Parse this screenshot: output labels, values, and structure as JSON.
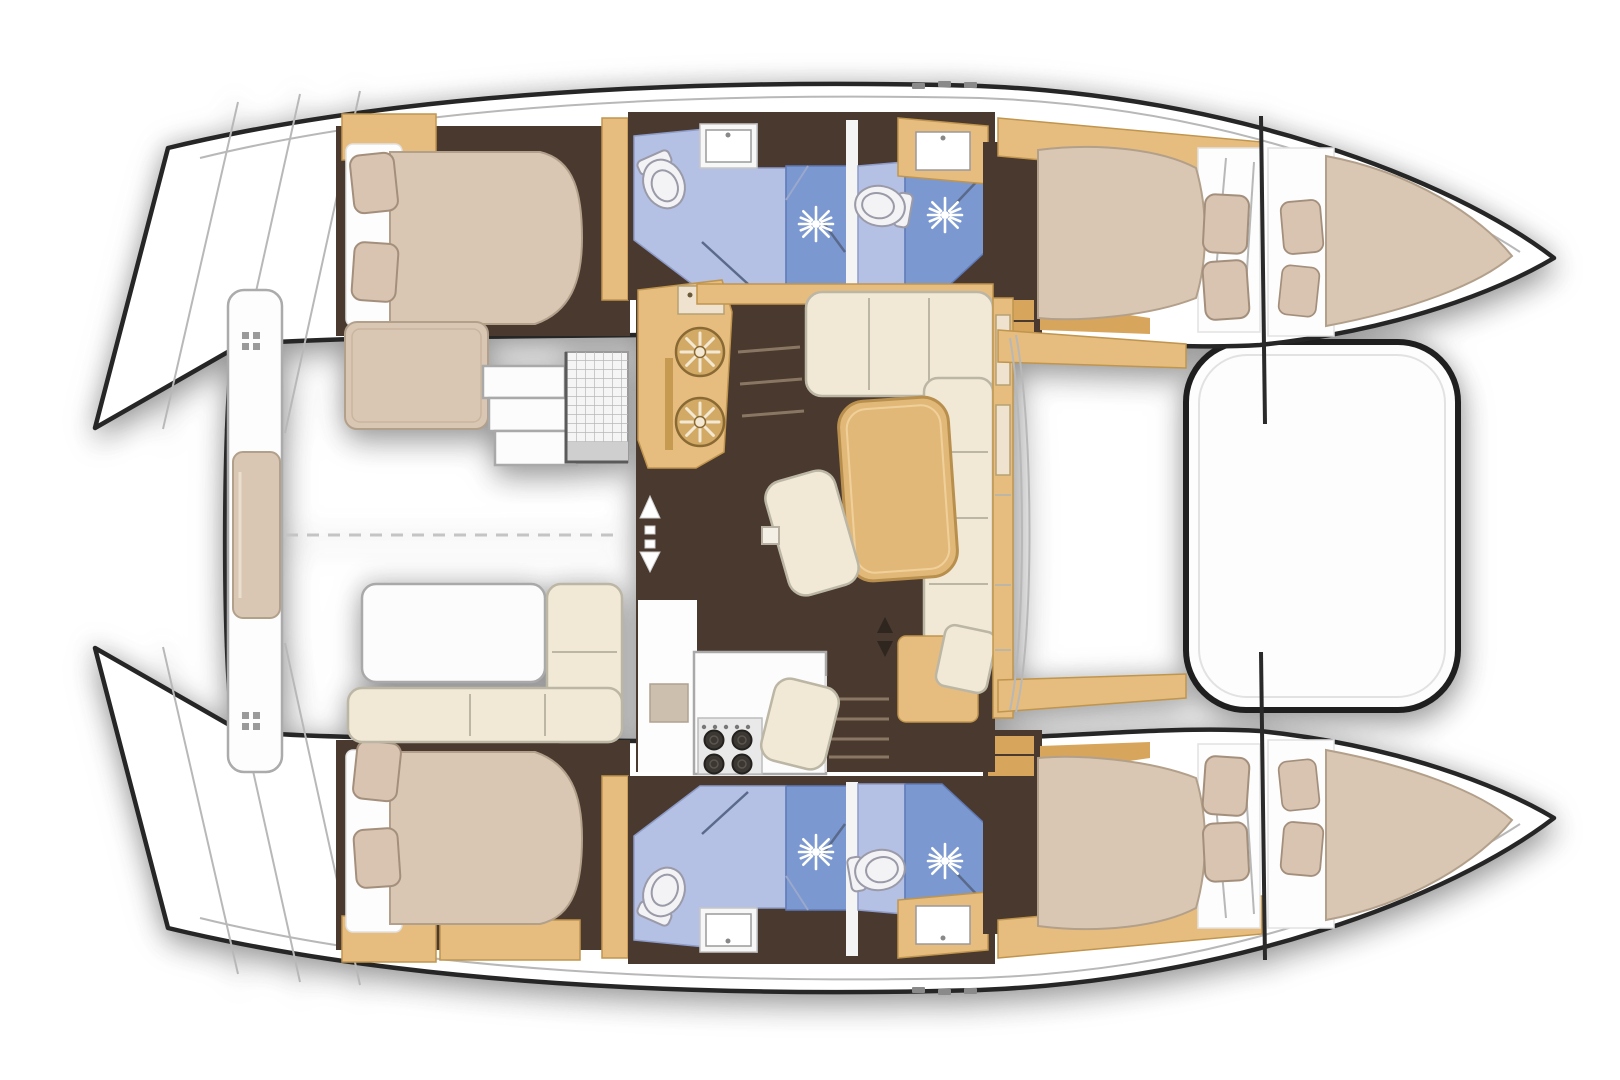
{
  "title": "Sailing catamaran interior floor plan — top-down layout, bows to the right: 4 double cabins, 4 bathrooms with showers, central saloon with galley, aft cockpit, bow trampoline",
  "plan": {
    "vessel_type": "sailing catamaran",
    "view": "top-down",
    "bow_side": "right",
    "stern_side": "left",
    "hulls": [
      "port hull (top)",
      "starboard hull (bottom)"
    ],
    "areas": [
      "aft cockpit",
      "saloon",
      "galley",
      "port aft cabin",
      "port forward cabin",
      "starboard aft cabin",
      "starboard forward cabin",
      "4 bathrooms",
      "2 forepeak berths",
      "foredeck",
      "trampoline",
      "transom steps"
    ]
  },
  "inventory": {
    "double_berths": 4,
    "forepeak_berths": 2,
    "pillows": 12,
    "toilets": 4,
    "showers": 4,
    "washbasins": 4,
    "galley_round_sinks": 2,
    "stove_burners": 4,
    "dining_table": 1,
    "ottomans": 2,
    "saloon_sofa_sections": 8,
    "cockpit_table": 1,
    "cockpit_settee": 1,
    "sunpad": 1,
    "liferaft_locker": 1,
    "trampoline": 1
  },
  "colors": {
    "background": "#ffffff",
    "hull-fill": "#ffffff",
    "hull-stroke": "#262626",
    "deck-line": "#b8b8b8",
    "floor-brown": "#4a392e",
    "wood": "#e6bd7e",
    "wood-dark": "#c0954e",
    "wood-mid": "#d8a55c",
    "wood-pale": "#efe3cf",
    "mattress": "#dac7b3",
    "mattress-stroke": "#b3a08b",
    "pillow": "#d8c4b0",
    "pillow-stroke": "#a38f7b",
    "cream": "#f1e9d6",
    "cream-stroke": "#bcb6a5",
    "table-wood": "#e2b878",
    "table-stroke": "#b98f4e",
    "bath-floor": "#b4c0e4",
    "shower-blue": "#7b98d0",
    "shower-line": "#5a6a8a",
    "fixture": "#f3f3f5",
    "fixture-stroke": "#9a9aa8",
    "white-box": "#fcfcfc",
    "box-stroke": "#a9a9a9",
    "step-line": "#8a7763",
    "burner": "#3b3733",
    "marker": "#2f2620"
  }
}
